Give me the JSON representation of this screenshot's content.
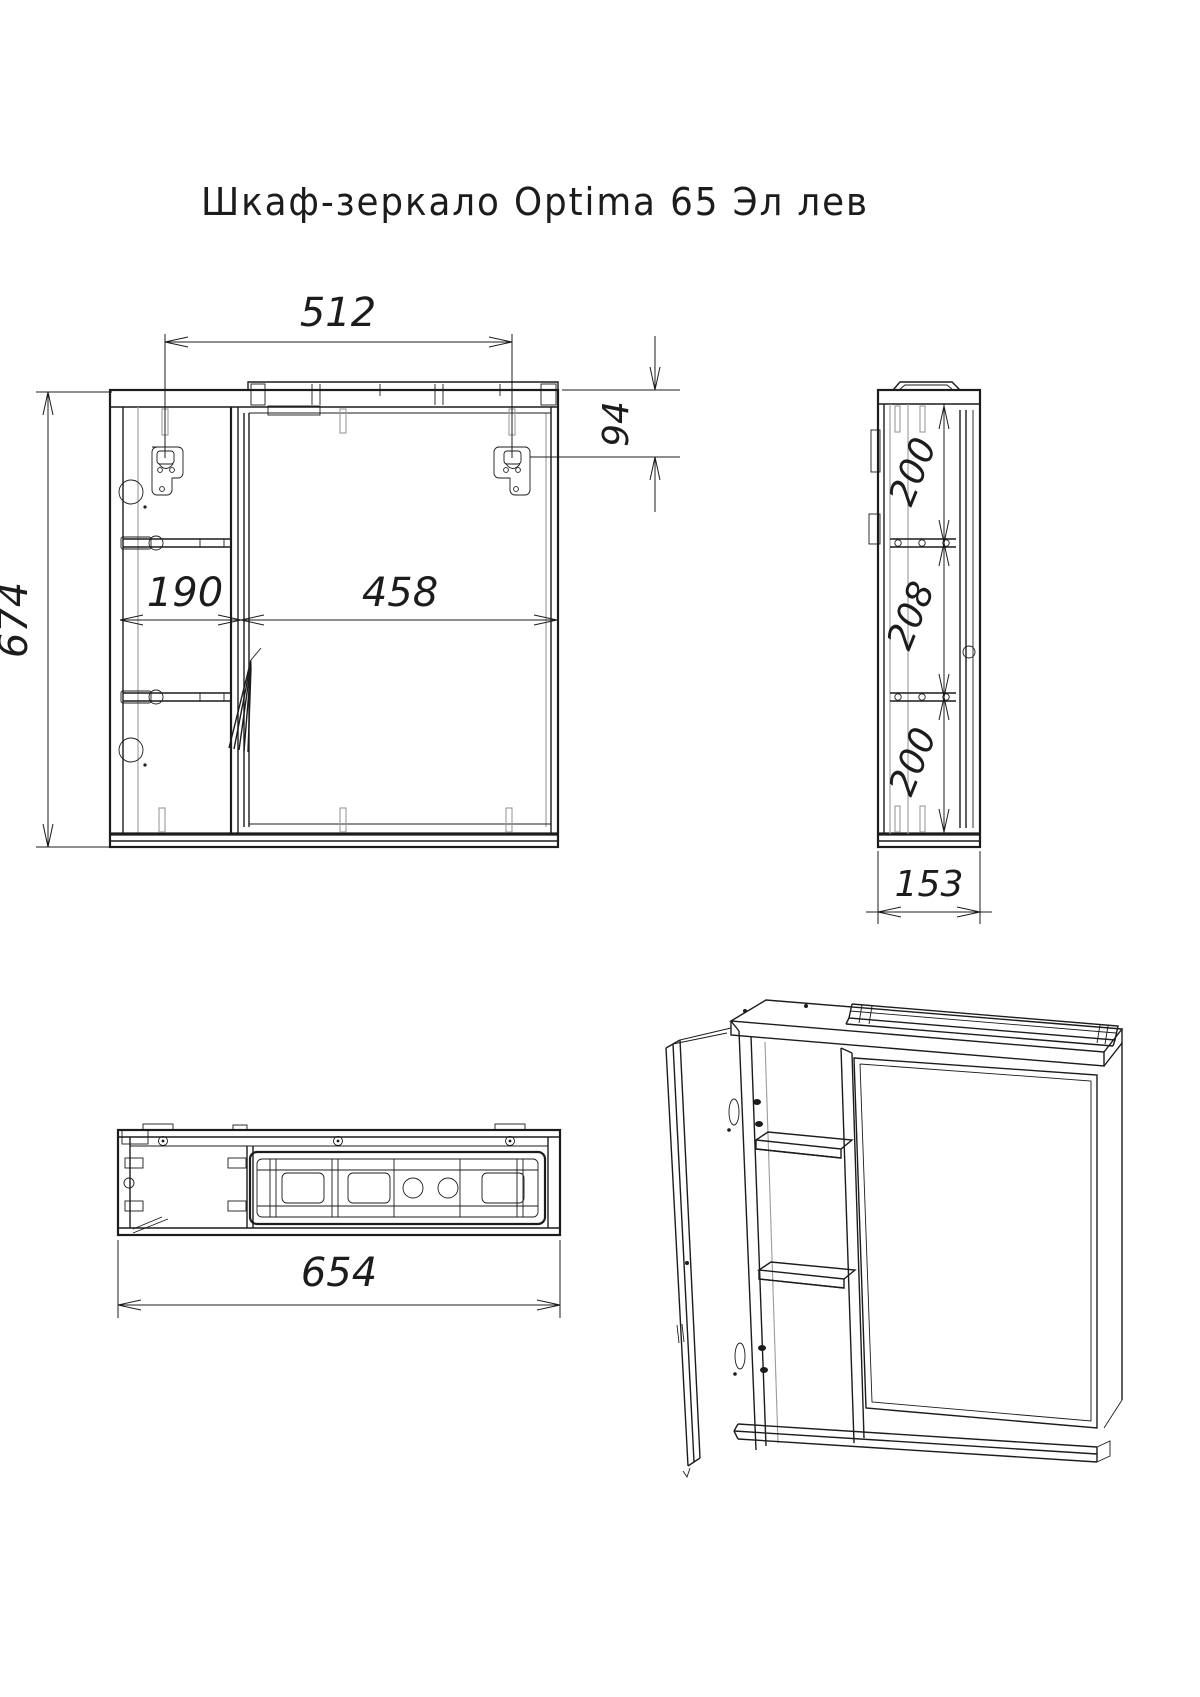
{
  "title": "Шкаф-зеркало Optima 65 Эл лев",
  "front_view": {
    "dim_hanger_span": "512",
    "dim_hanger_offset": "94",
    "dim_left_section_width": "190",
    "dim_door_width": "458",
    "dim_height": "674"
  },
  "side_view": {
    "dim_top_section": "200",
    "dim_middle_section": "208",
    "dim_bottom_section": "200",
    "dim_depth": "153"
  },
  "bottom_view": {
    "dim_width": "654"
  },
  "colors": {
    "line": "#1c1c1c",
    "background": "#ffffff"
  }
}
